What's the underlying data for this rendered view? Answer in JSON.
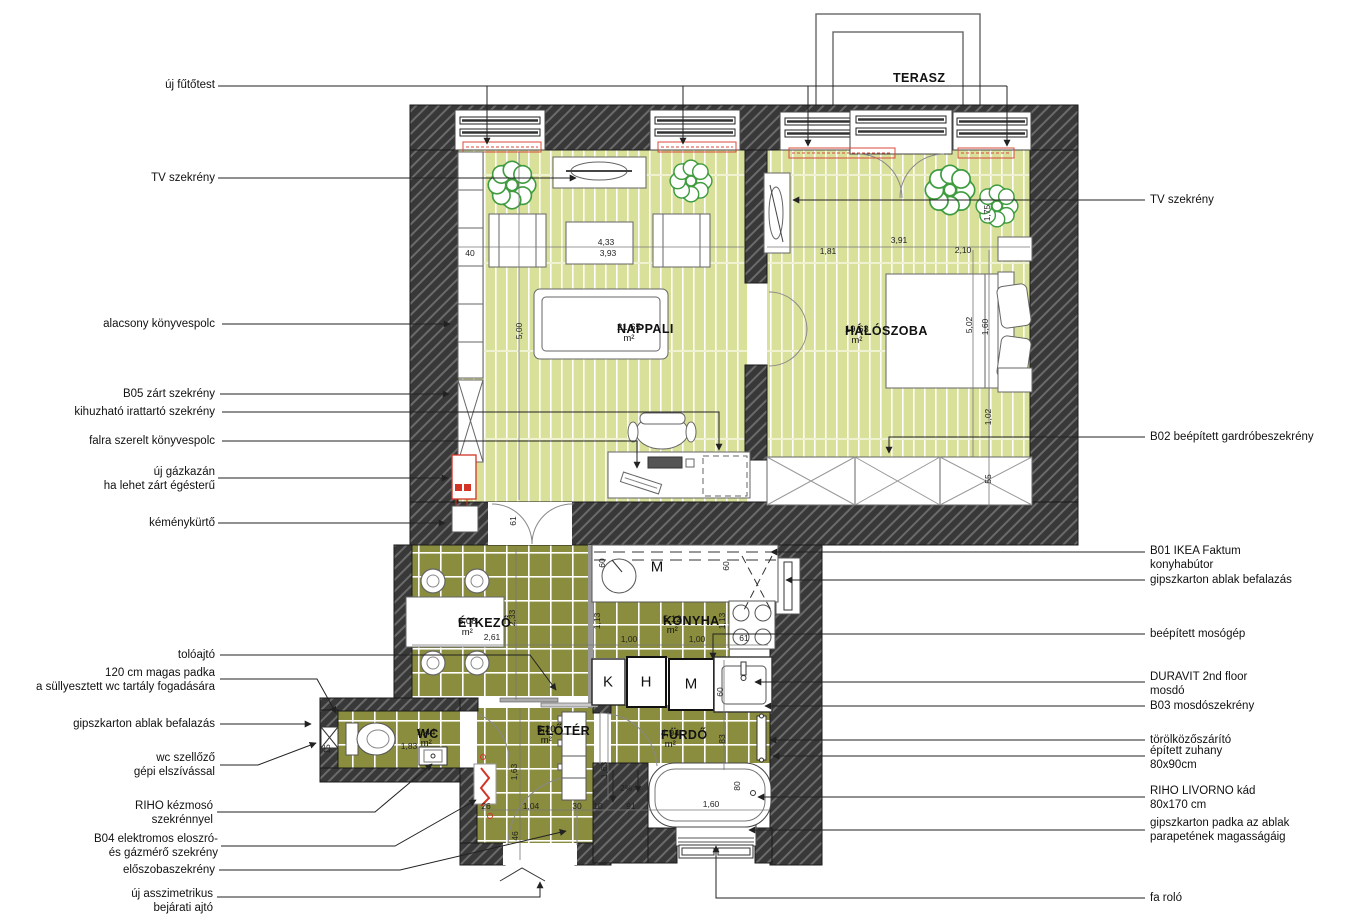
{
  "colors": {
    "wall": "#383838",
    "wall_hatch": "#6a6a6a",
    "floor_parquet": "#d9e09a",
    "floor_tile": "#8a8d3e",
    "radiator_red": "#d94a38",
    "plant_green": "#3f9c3f",
    "line": "#222222"
  },
  "rooms": [
    {
      "name": "TERASZ",
      "area": "",
      "x": 893,
      "y": 71
    },
    {
      "name": "NAPPALI",
      "area": "21,65 m²",
      "x": 617,
      "y": 322
    },
    {
      "name": "HÁLÓSZOBA",
      "area": "19,63 m²",
      "x": 845,
      "y": 324
    },
    {
      "name": "ÉTKEZŐ",
      "area": "6,08 m²",
      "x": 458,
      "y": 616
    },
    {
      "name": "KONYHA",
      "area": "5,12 m²",
      "x": 663,
      "y": 614
    },
    {
      "name": "WC",
      "area": "1,44 m²",
      "x": 417,
      "y": 727
    },
    {
      "name": "ELŐTÉR",
      "area": "5,20 m²",
      "x": 537,
      "y": 724
    },
    {
      "name": "FÜRDŐ",
      "area": "4,94 m²",
      "x": 661,
      "y": 728
    }
  ],
  "appliance_letters": [
    {
      "t": "M",
      "x": 657,
      "y": 567
    },
    {
      "t": "K",
      "x": 608,
      "y": 682
    },
    {
      "t": "H",
      "x": 646,
      "y": 682
    },
    {
      "t": "M",
      "x": 691,
      "y": 684
    }
  ],
  "dimensions": [
    {
      "t": "40",
      "x": 470,
      "y": 253
    },
    {
      "t": "4,33",
      "x": 606,
      "y": 242
    },
    {
      "t": "3,93",
      "x": 608,
      "y": 253
    },
    {
      "t": "5,00",
      "x": 519,
      "y": 331,
      "v": true
    },
    {
      "t": "1,81",
      "x": 828,
      "y": 251
    },
    {
      "t": "3,91",
      "x": 899,
      "y": 240
    },
    {
      "t": "2,10",
      "x": 963,
      "y": 250
    },
    {
      "t": "1,75",
      "x": 987,
      "y": 213,
      "v": true
    },
    {
      "t": "5,02",
      "x": 969,
      "y": 325,
      "v": true
    },
    {
      "t": "1,60",
      "x": 985,
      "y": 327,
      "v": true
    },
    {
      "t": "1,02",
      "x": 988,
      "y": 417,
      "v": true
    },
    {
      "t": "55",
      "x": 988,
      "y": 479,
      "v": true
    },
    {
      "t": "61",
      "x": 513,
      "y": 521,
      "v": true
    },
    {
      "t": "2,33",
      "x": 512,
      "y": 618,
      "v": true
    },
    {
      "t": "2,61",
      "x": 492,
      "y": 637
    },
    {
      "t": "60",
      "x": 602,
      "y": 563,
      "v": true
    },
    {
      "t": "1,13",
      "x": 597,
      "y": 621,
      "v": true
    },
    {
      "t": "1,00",
      "x": 629,
      "y": 639
    },
    {
      "t": "1,00",
      "x": 697,
      "y": 639
    },
    {
      "t": "1,13",
      "x": 722,
      "y": 621,
      "v": true
    },
    {
      "t": "60",
      "x": 726,
      "y": 566,
      "v": true
    },
    {
      "t": "61",
      "x": 744,
      "y": 638
    },
    {
      "t": "15",
      "x": 327,
      "y": 749,
      "v": true
    },
    {
      "t": "1,83",
      "x": 409,
      "y": 746
    },
    {
      "t": "1,63",
      "x": 514,
      "y": 772,
      "v": true
    },
    {
      "t": "1,63",
      "x": 604,
      "y": 770,
      "v": true
    },
    {
      "t": "26",
      "x": 486,
      "y": 806
    },
    {
      "t": "1,04",
      "x": 531,
      "y": 806
    },
    {
      "t": "30",
      "x": 577,
      "y": 806
    },
    {
      "t": "10",
      "x": 598,
      "y": 806
    },
    {
      "t": "91",
      "x": 631,
      "y": 806
    },
    {
      "t": "1,60",
      "x": 711,
      "y": 804
    },
    {
      "t": "80",
      "x": 737,
      "y": 786,
      "v": true
    },
    {
      "t": "2%",
      "x": 626,
      "y": 788
    },
    {
      "t": "46",
      "x": 515,
      "y": 836,
      "v": true
    },
    {
      "t": "83",
      "x": 722,
      "y": 739,
      "v": true
    },
    {
      "t": "60",
      "x": 720,
      "y": 692,
      "v": true
    }
  ],
  "callouts": {
    "left": [
      {
        "text": "új fűtőtest",
        "x": 215,
        "y": 85
      },
      {
        "text": "TV szekrény",
        "x": 215,
        "y": 178
      },
      {
        "text": "alacsony könyvespolc",
        "x": 215,
        "y": 324
      },
      {
        "text": "B05 zárt szekrény",
        "x": 215,
        "y": 394
      },
      {
        "text": "kihuzható irattartó szekrény",
        "x": 215,
        "y": 412
      },
      {
        "text": "falra szerelt könyvespolc",
        "x": 215,
        "y": 441
      },
      {
        "text": "új gázkazán\nha lehet zárt égésterű",
        "x": 215,
        "y": 479
      },
      {
        "text": "kéménykürtő",
        "x": 215,
        "y": 523
      },
      {
        "text": "tolóajtó",
        "x": 215,
        "y": 655
      },
      {
        "text": "120 cm magas padka\na süllyesztett wc tartály fogadására",
        "x": 215,
        "y": 680
      },
      {
        "text": "gipszkarton ablak befalazás",
        "x": 215,
        "y": 724
      },
      {
        "text": "wc szellőző\ngépi elszívással",
        "x": 215,
        "y": 765
      },
      {
        "text": "RIHO kézmosó\nszekrénnyel",
        "x": 213,
        "y": 813
      },
      {
        "text": "B04 elektromos eloszró-\nés gázmérő szekrény",
        "x": 218,
        "y": 846
      },
      {
        "text": "előszobaszekrény",
        "x": 215,
        "y": 870
      },
      {
        "text": "új asszimetrikus\nbejárati ajtó",
        "x": 213,
        "y": 901
      }
    ],
    "right": [
      {
        "text": "TV szekrény",
        "x": 1150,
        "y": 200
      },
      {
        "text": "B02 beépített gardróbeszekrény",
        "x": 1150,
        "y": 437
      },
      {
        "text": "B01 IKEA Faktum\nkonyhabútor",
        "x": 1150,
        "y": 558
      },
      {
        "text": "gipszkarton ablak befalazás",
        "x": 1150,
        "y": 580
      },
      {
        "text": "beépített mosógép",
        "x": 1150,
        "y": 634
      },
      {
        "text": "DURAVIT 2nd floor\nmosdó",
        "x": 1150,
        "y": 684
      },
      {
        "text": "B03 mosdószekrény",
        "x": 1150,
        "y": 706
      },
      {
        "text": "törölközőszárító",
        "x": 1150,
        "y": 740
      },
      {
        "text": "épített zuhany\n80x90cm",
        "x": 1150,
        "y": 758
      },
      {
        "text": "RIHO LIVORNO kád\n80x170 cm",
        "x": 1150,
        "y": 798
      },
      {
        "text": "gipszkarton padka az ablak\nparapetének magasságáig",
        "x": 1150,
        "y": 830
      },
      {
        "text": "fa roló",
        "x": 1150,
        "y": 898
      }
    ]
  }
}
